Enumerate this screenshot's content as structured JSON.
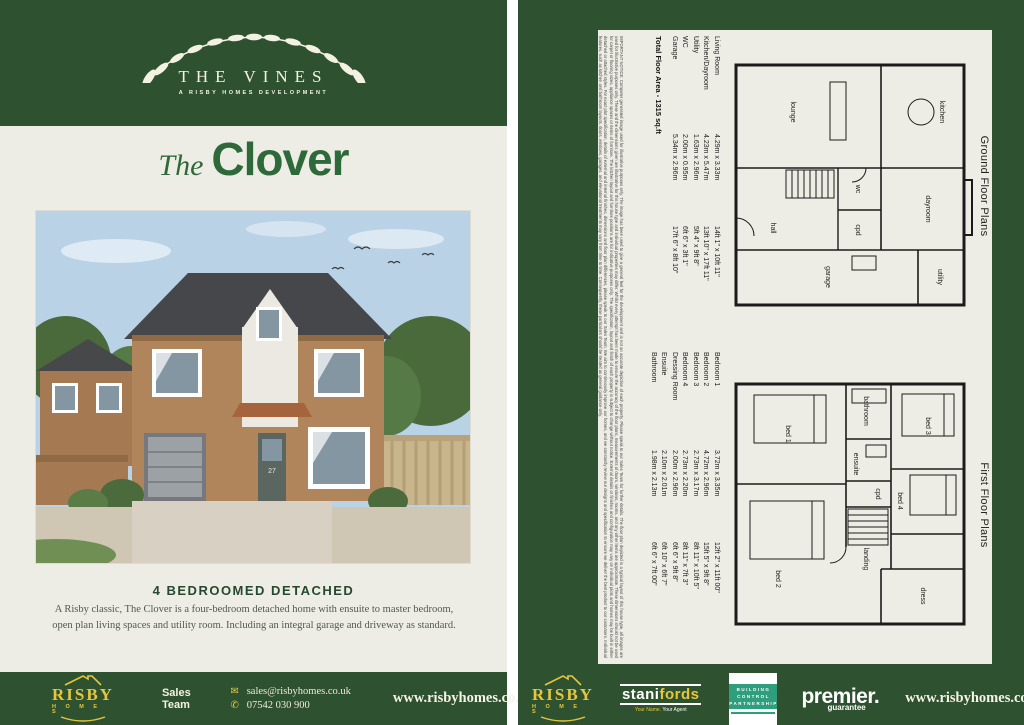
{
  "brand": {
    "risby_name": "RISBY",
    "risby_homes": "H O M E S"
  },
  "colors": {
    "green": "#2e5230",
    "cream": "#edece5",
    "gold": "#e7c53d",
    "title_green": "#2e6a39",
    "bcp_green": "#2f9e7c"
  },
  "left_page": {
    "header": {
      "name": "THE VINES",
      "subtitle": "A RISBY HOMES DEVELOPMENT"
    },
    "title_prefix": "The",
    "title": "Clover",
    "subheading": "4 BEDROOMED DETACHED",
    "description": "A Risby classic, The Clover is a four-bedroom detached home with ensuite to master bedroom, open plan living spaces and utility room. Including an integral garage and driveway as standard.",
    "house": {
      "door_number": "27"
    },
    "footer": {
      "sales_team": "Sales Team",
      "email": "sales@risbyhomes.co.uk",
      "phone": "07542 030 900",
      "website": "www.risbyhomes.co.uk"
    }
  },
  "right_page": {
    "ground": {
      "title": "Ground Floor Plans",
      "rooms": [
        {
          "name": "Living Room",
          "metric": "4.29m x 3.33m",
          "imperial": "14ft 1\" x 10ft 11\""
        },
        {
          "name": "Kitchen/Dayroom",
          "metric": "4.23m x 5.47m",
          "imperial": "13ft 10\" x 17ft 11\""
        },
        {
          "name": "Utility",
          "metric": "1.63m x 2.96m",
          "imperial": "5ft 4\" x 9ft 8\""
        },
        {
          "name": "WC",
          "metric": "2.00m x 0.95m",
          "imperial": "6ft 6\" x 3ft 1\""
        },
        {
          "name": "Garage",
          "metric": "5.34m x 2.96m",
          "imperial": "17ft 6\" x 8ft 10\""
        }
      ],
      "plan_labels": {
        "kitchen": "kitchen",
        "dayroom": "dayroom",
        "utility": "utility",
        "garage": "garage",
        "lounge": "lounge",
        "hall": "hall",
        "wc": "wc",
        "cpd": "cpd"
      }
    },
    "first": {
      "title": "First Floor Plans",
      "rooms": [
        {
          "name": "Bedroom 1",
          "metric": "3.72m x 3.35m",
          "imperial": "12ft 2\" x 11ft 00\""
        },
        {
          "name": "Bedroom 2",
          "metric": "4.72m x 2.96m",
          "imperial": "15ft 5\" x 9ft 8\""
        },
        {
          "name": "Bedroom 3",
          "metric": "2.73m x 3.17m",
          "imperial": "8ft 11\" x 10ft 5\""
        },
        {
          "name": "Bedroom 4",
          "metric": "2.73m x 2.20m",
          "imperial": "8ft 11\" x 7ft 3\""
        },
        {
          "name": "Dressing Room",
          "metric": "2.00m x 2.96m",
          "imperial": "6ft 6\" x 9ft 8\""
        },
        {
          "name": "Ensuite",
          "metric": "2.10m x 2.01m",
          "imperial": "6ft 10\" x 6ft 7\""
        },
        {
          "name": "Bathroom",
          "metric": "1.98m x 2.13m",
          "imperial": "6ft 6\" x 7ft 00\""
        }
      ],
      "plan_labels": {
        "bed1": "bed 1",
        "bed2": "bed 2",
        "bed3": "bed 3",
        "bed4": "bed 4",
        "bathroom": "bathroom",
        "ensuite": "ensuite",
        "cpd": "cpd",
        "landing": "landing",
        "dress": "dress"
      }
    },
    "total_area": "Total Floor Area - 1315 sq.ft",
    "disclaimer": "IMPORTANT NOTICE: Computer generated image used for illustrative purposes only. The image has been used to give a general feel for the development and is not an accurate depiction of each property. Please speak to our Sales Team for further details. The floor plan depicted is a typical layout of this house type, all images are used for illustrative purposes only. These and the dimensions given are illustrative for this house type and individual properties may differ. Whilst every attempt has been made to ensure the accuracy of the floor plans, measurements of doors, windows, rooms, and any other items are approximate. These dimensions should not be used for carpet or flooring sizes, appliance spaces or items of furniture. The kitchen layout and furniture positions are for indicative purposes only. The specification, layout and finish of each property is subject to change without notice. External details or finishes and configuration may vary on individual plots and homes may be built in either detached or attached styles. For exact plot specification, details of external and internal finishes, dimensions and floor plan differences, please speak to our Sales Team. We aim to continuously improve our homes, and we constantly review our designs and specification to ensure we deliver the best product to our customers. Individual features, such as kitchen and bathroom layouts, doors, windows, garages, and elevational treatments may vary from time to time. Consequently, these particulars should be treated as general guidance only.",
    "footer": {
      "stanifords_1": "stani",
      "stanifords_2": "fords",
      "stanifords_tag1": "Your Name.",
      "stanifords_tag2": "Your Agent",
      "bcp_line1": "BUILDING",
      "bcp_line2": "CONTROL",
      "bcp_line3": "PARTNERSHIP",
      "premier_1": "premier.",
      "premier_2": "guarantee",
      "website": "www.risbyhomes.co.uk"
    }
  }
}
